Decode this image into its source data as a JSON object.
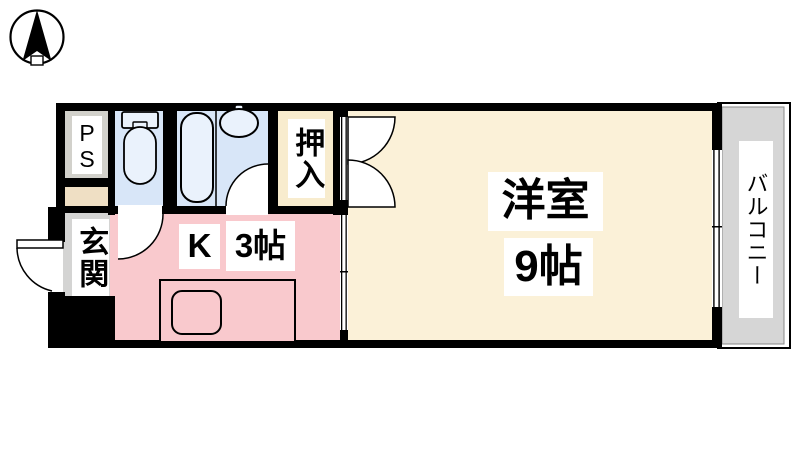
{
  "plan": {
    "compass": "north-arrow",
    "rooms": {
      "ps": {
        "label": "PS"
      },
      "genkan": {
        "label": "玄関"
      },
      "oshiire": {
        "label": "押入"
      },
      "kitchen": {
        "label_type": "K",
        "label_size": "3帖"
      },
      "western_room": {
        "label_name": "洋室",
        "label_size": "9帖"
      },
      "balcony": {
        "label": "バルコニー"
      }
    },
    "colors": {
      "wall": "#000000",
      "room_cream": "#FBF1D8",
      "closet_cream": "#F8ECCE",
      "kitchen_pink": "#F9C9CD",
      "wet_blue": "#D8E6F8",
      "fixture_blue": "#EAF2FC",
      "ps_gray": "#D2D1CB",
      "genkan_gray": "#D4D4D3",
      "nook_beige": "#EFDFC4",
      "balcony_gray": "#D6D6D6"
    }
  }
}
